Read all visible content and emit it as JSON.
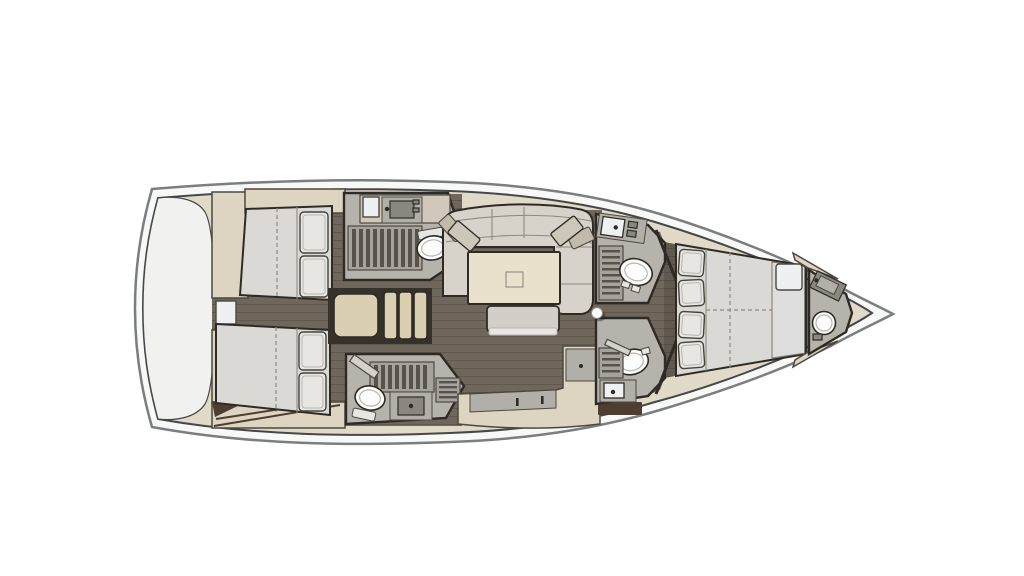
{
  "meta": {
    "type": "sailing-yacht-interior-floor-plan",
    "view": "top-down",
    "orientation": "bow to the right, stern to the left"
  },
  "colors": {
    "hullRim": "#f8f8f7",
    "hullOutline": "#7b7e80",
    "hullInner": "#45484b",
    "deck": "#e2dac8",
    "transom": "#f1f1ef",
    "floor": "#6f675b",
    "floorLine": "#5f584d",
    "cabinet": "#ddd5c1",
    "wall": "#2e2b26",
    "wallSoft": "#4c4841",
    "mattress": "#dbd9d6",
    "pillow": "#e7e6e3",
    "pillowLine": "#474439",
    "bathFloor": "#b6b3ad",
    "grateBg": "#a7a39c",
    "grateSlat": "#57534b",
    "fixture": "#fcfcfb",
    "fixtureInner": "#b7b5b0",
    "tank": "#e6e6e3",
    "sinkDark": "#8b8780",
    "counterTop": "#d0c9bb",
    "counterFace": "#b2afa8",
    "sofa": "#d7d3ca",
    "seam": "#8f8b80",
    "throwPillow": "#cdc7ba",
    "throwPillow2": "#c2bbac",
    "table": "#e9e1cb",
    "bench": "#d3cfc8",
    "stepsBg": "#36322b",
    "steps": "#dbcfb2",
    "woodAccent": "#4e3e30",
    "fwdPanel": "#dcdddc",
    "panelLine": "#7a776f",
    "fwdWhite": "#eef0f1",
    "doorLeaf": "#d6d2ca",
    "mast": "#ffffff"
  },
  "vessel": {
    "areas": [
      {
        "id": "transom",
        "label": "Stern transom locker"
      },
      {
        "id": "aft-cabin-top",
        "label": "Aft double cabin (upper)",
        "features": [
          "double bed",
          "two pillows",
          "wardrobe"
        ]
      },
      {
        "id": "aft-cabin-bottom",
        "label": "Aft double cabin (lower)",
        "features": [
          "double bed",
          "two pillows",
          "wardrobe"
        ]
      },
      {
        "id": "head-aft-top",
        "label": "Aft head with shower (upper)",
        "features": [
          "shower grate",
          "toilet",
          "sink"
        ]
      },
      {
        "id": "head-aft-bottom",
        "label": "Aft head with shower (lower)",
        "features": [
          "shower grate",
          "toilet",
          "sink"
        ]
      },
      {
        "id": "companionway",
        "label": "Companionway steps"
      },
      {
        "id": "salon",
        "label": "Salon with sofa, dining table and bench"
      },
      {
        "id": "galley",
        "label": "L-shaped galley"
      },
      {
        "id": "head-fwd-top",
        "label": "Forward head (upper)",
        "features": [
          "sink",
          "shower grate",
          "toilet"
        ]
      },
      {
        "id": "head-fwd-bottom",
        "label": "Forward head (lower)",
        "features": [
          "toilet",
          "shower grate",
          "sink"
        ]
      },
      {
        "id": "forward-cabin",
        "label": "Forward owner cabin with double bed"
      },
      {
        "id": "bow-head",
        "label": "Bow bathroom",
        "features": [
          "sink",
          "toilet"
        ]
      },
      {
        "id": "mast",
        "label": "Mast position"
      }
    ]
  }
}
